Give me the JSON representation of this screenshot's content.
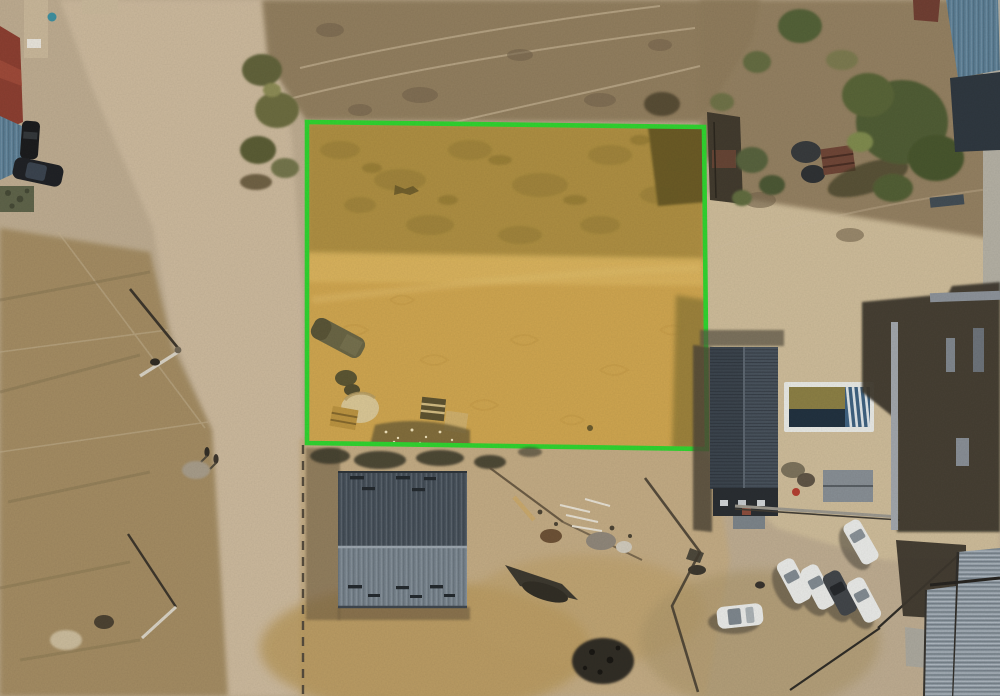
{
  "scene": {
    "description": "Aerial drone photograph of a dusty suburban lot: a vacant rectangular land parcel outlined with a bright green boundary and tinted golden-yellow, beside a dirt road, dry scrub fields, a large grey gabled metal roof building, a house with a dark ridged roof and swimming pool, trees, construction debris and six parked cars.",
    "parcel": {
      "outline_color_name": "bright green",
      "tint_name": "golden yellow"
    },
    "vehicles": {
      "white_cars": 5,
      "dark_cars": 3
    },
    "buildings": {
      "center_warehouse": 1,
      "right_house_with_pool": 1,
      "construction_right": 2,
      "top_left_compound": 1
    }
  },
  "palette": {
    "highlight_green": "#2dd32d",
    "parcel_gold": "#c89f50",
    "parcel_olive": "#a08441",
    "parcel_band": "#d6b264",
    "parcel_tint": "#f2be3c",
    "sand_base": "#bdab8f",
    "road_light": "#cbb89b",
    "scrub_left": "#a28a61",
    "scrub_top": "#8e7a5a",
    "dirt_bottom": "#c2aa82",
    "dirt_right": "#cdbb98",
    "roof_slate_dark": "#454f59",
    "roof_slate_light": "#76828c",
    "house_roof": "#39424b",
    "corrugated": "#8e99a2",
    "car_white": "#e9eae7",
    "car_dark": "#3f4347",
    "tree_green": "#4d5a31",
    "pool_white": "#e8e9e4",
    "pool_water": "#1e2f3d",
    "pool_stripe": "#4a7ca6",
    "pool_lawn": "#8a7d42",
    "red_roof": "#8a3c2e",
    "blue_roof": "#5b7e95",
    "camo_green": "#5c6147",
    "shadow_dark": "#3a342a",
    "pale_wall": "#b3afa2"
  }
}
